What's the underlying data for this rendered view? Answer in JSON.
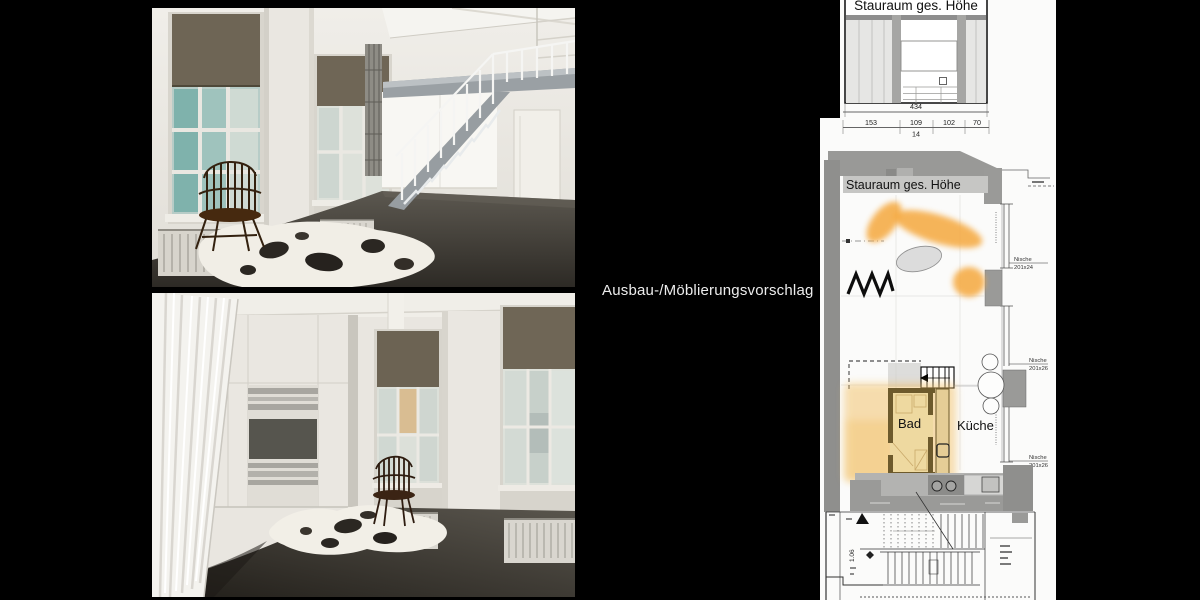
{
  "slide": {
    "annotation": "Ausbau-/Möblierungsvorschlag"
  },
  "plan": {
    "elevation": {
      "title": "Stauraum ges. Höhe"
    },
    "dimensions": {
      "total": "434",
      "segments": [
        "153",
        "109",
        "102",
        "70"
      ],
      "sub": "14"
    },
    "floor": {
      "storage_label": "Stauraum ges. Höhe",
      "bad_label": "Bad",
      "kueche_label": "Küche",
      "stair_label": "1.06",
      "niches": [
        {
          "name": "Nische",
          "size": "201x24"
        },
        {
          "name": "Nische",
          "size": "201x26"
        },
        {
          "name": "Nische",
          "size": "201x26"
        }
      ]
    },
    "colors": {
      "highlight_orange": "#F5A83C",
      "bad_fill": "#EDD9A2",
      "bad_wall": "#6D5A2C",
      "wall_gray": "#9A9A9A"
    }
  }
}
